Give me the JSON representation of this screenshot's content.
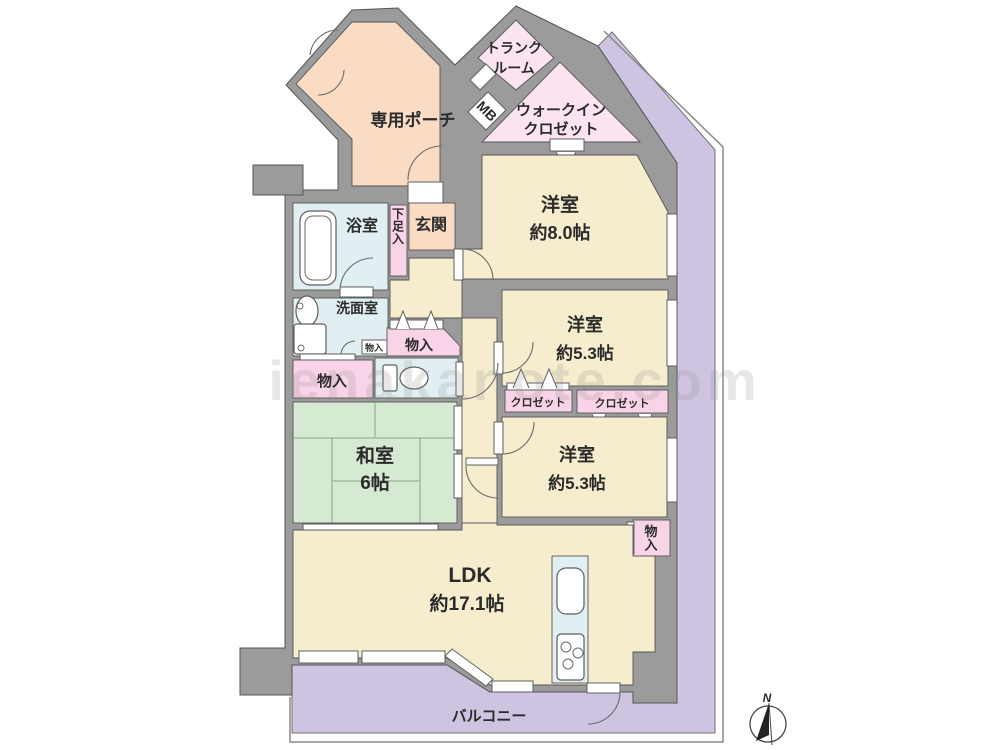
{
  "watermark": "ienakanote.com",
  "compass": {
    "north_label": "N"
  },
  "rooms": {
    "porch": "専用ポーチ",
    "trunk_line1": "トランク",
    "trunk_line2": "ルーム",
    "mb": "MB",
    "wic_line1": "ウォークイン",
    "wic_line2": "クロゼット",
    "bedroom8_name": "洋室",
    "bedroom8_size": "約8.0帖",
    "bath": "浴室",
    "entrance": "玄関",
    "shoe_storage": "下足入",
    "washroom": "洗面室",
    "storage_small": "物入",
    "storage_hall": "物入",
    "storage_west": "物入",
    "storage_br": "物入",
    "bedroom53a_name": "洋室",
    "bedroom53a_size": "約5.3帖",
    "closet1": "クロゼット",
    "closet2": "クロゼット",
    "washitsu_name": "和室",
    "washitsu_size": "6帖",
    "bedroom53b_name": "洋室",
    "bedroom53b_size": "約5.3帖",
    "ldk_name": "LDK",
    "ldk_size": "約17.1帖",
    "balcony": "バルコニー"
  },
  "colors": {
    "wall": "#9b9b9b",
    "room_cream": "#f6ecce",
    "tatami_green": "#d6e9d2",
    "entrance_peach": "#fadbc3",
    "closet_pink": "#f9d3e7",
    "closet_pink_light": "#fbe3f1",
    "wet_area_blue": "#e2eff2",
    "balcony_lavender": "#cfc3e2"
  }
}
